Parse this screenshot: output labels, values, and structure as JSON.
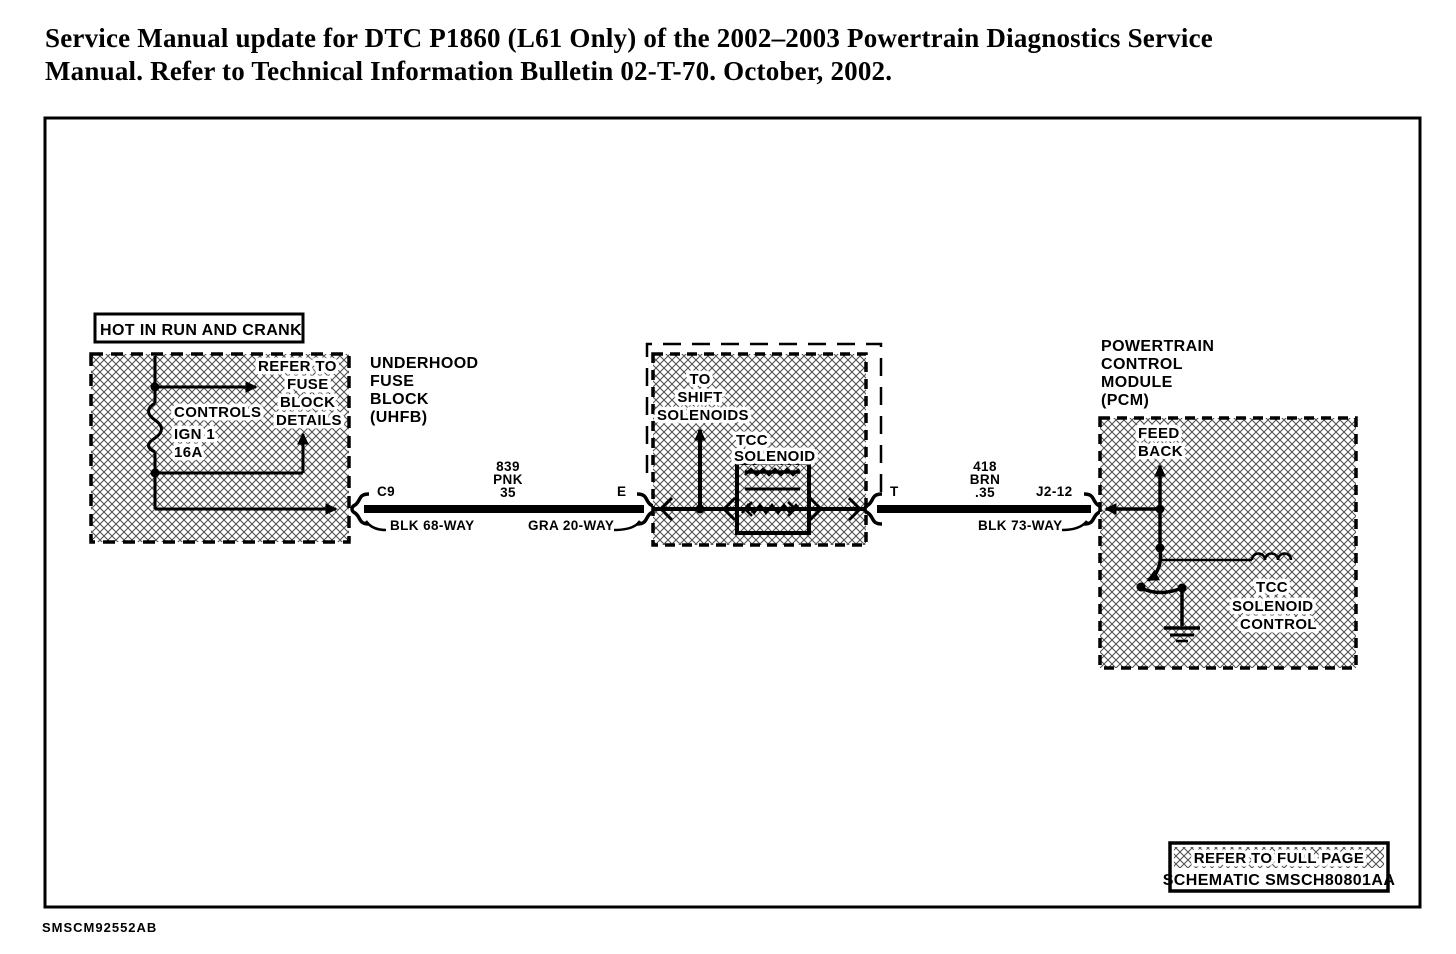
{
  "page": {
    "ink": "#000000",
    "paper": "#ffffff"
  },
  "title": {
    "line1": "Service Manual update for DTC P1860 (L61 Only) of the 2002–2003 Powertrain Diagnostics Service",
    "line2": "Manual.  Refer to Technical Information Bulletin 02-T-70.  October, 2002."
  },
  "uhfb": {
    "power_label": "HOT IN RUN AND CRANK",
    "note_lines": [
      "REFER TO",
      "FUSE",
      "BLOCK",
      "DETAILS"
    ],
    "controls_label": "CONTROLS",
    "fuse_name": "IGN 1",
    "fuse_rating": "16A",
    "name_lines": [
      "UNDERHOOD",
      "FUSE",
      "BLOCK",
      "(UHFB)"
    ]
  },
  "wire_839": {
    "from_pin": "C9",
    "to_pin": "E",
    "circuit": "839",
    "color": "PNK",
    "size": "35",
    "from_connector": "BLK  68-WAY",
    "to_connector": "GRA  20-WAY"
  },
  "transmission": {
    "shift_lines": [
      "TO",
      "SHIFT",
      "SOLENOIDS"
    ],
    "tcc_lines": [
      "TCC",
      "SOLENOID"
    ]
  },
  "wire_418": {
    "from_pin": "T",
    "to_pin": "J2-12",
    "circuit": "418",
    "color": "BRN",
    "size": ".35",
    "connector": "BLK  73-WAY"
  },
  "pcm": {
    "name_lines": [
      "POWERTRAIN",
      "CONTROL",
      "MODULE",
      "(PCM)"
    ],
    "feedback_lines": [
      "FEED",
      "BACK"
    ],
    "tcc_control_lines": [
      "TCC",
      "SOLENOID",
      "CONTROL"
    ]
  },
  "footer": {
    "refer_line1": "REFER TO FULL PAGE",
    "refer_line2": "SCHEMATIC SMSCH80801AA",
    "doc_id": "SMSCM92552AB"
  }
}
